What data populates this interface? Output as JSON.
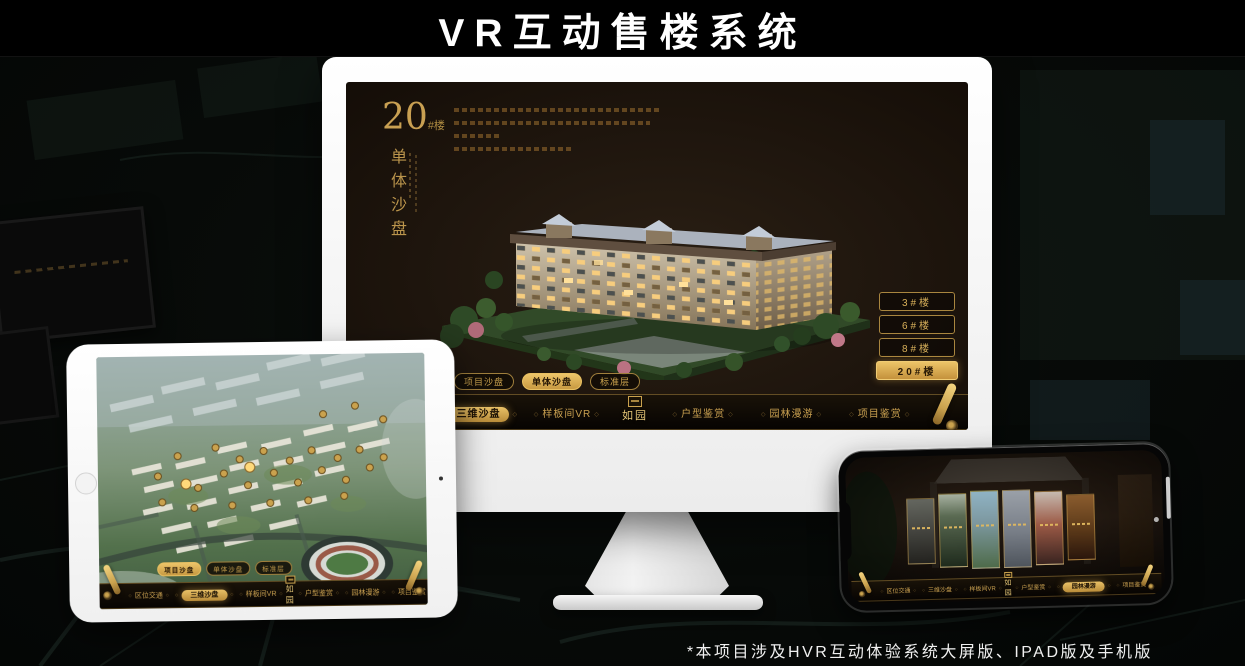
{
  "page": {
    "title": "VR互动售楼系统",
    "footnote": "*本项目涉及HVR互动体验系统大屏版、IPAD版及手机版"
  },
  "colors": {
    "gold_text": "#c9a050",
    "gold_active": "#e0b35a",
    "screen_background": "#1e150d",
    "nav_background": "#0b0805",
    "title_color": "#ffffff"
  },
  "monitor": {
    "headline": {
      "number": "20",
      "unit": "#楼",
      "vertical_title": "单体沙盘"
    },
    "building_buttons": [
      {
        "label": "3#楼",
        "active": false
      },
      {
        "label": "6#楼",
        "active": false
      },
      {
        "label": "8#楼",
        "active": false
      },
      {
        "label": "20#楼",
        "active": true
      }
    ],
    "sub_tabs": [
      {
        "label": "项目沙盘",
        "active": false
      },
      {
        "label": "单体沙盘",
        "active": true
      },
      {
        "label": "标准层",
        "active": false
      }
    ],
    "nav": {
      "logo": "如园",
      "items_left": [
        {
          "label": "区位交通",
          "active": false
        },
        {
          "label": "三维沙盘",
          "active": true
        },
        {
          "label": "样板间VR",
          "active": false
        }
      ],
      "items_right": [
        {
          "label": "户型鉴赏",
          "active": false
        },
        {
          "label": "园林漫游",
          "active": false
        },
        {
          "label": "项目鉴赏",
          "active": false
        }
      ]
    }
  },
  "ipad": {
    "sub_tabs": [
      {
        "label": "项目沙盘",
        "active": true
      },
      {
        "label": "单体沙盘",
        "active": false
      },
      {
        "label": "标准层",
        "active": false
      }
    ],
    "nav": {
      "logo": "如园",
      "items_left": [
        {
          "label": "区位交通",
          "active": false
        },
        {
          "label": "三维沙盘",
          "active": true
        },
        {
          "label": "样板间VR",
          "active": false
        }
      ],
      "items_right": [
        {
          "label": "户型鉴赏",
          "active": false
        },
        {
          "label": "园林漫游",
          "active": false
        },
        {
          "label": "项目鉴赏",
          "active": false
        }
      ]
    }
  },
  "phone": {
    "nav": {
      "logo": "如园",
      "items_left": [
        {
          "label": "区位交通",
          "active": false
        },
        {
          "label": "三维沙盘",
          "active": false
        },
        {
          "label": "样板间VR",
          "active": false
        }
      ],
      "items_right": [
        {
          "label": "户型鉴赏",
          "active": false
        },
        {
          "label": "园林漫游",
          "active": true
        },
        {
          "label": "项目鉴赏",
          "active": false
        }
      ]
    }
  }
}
